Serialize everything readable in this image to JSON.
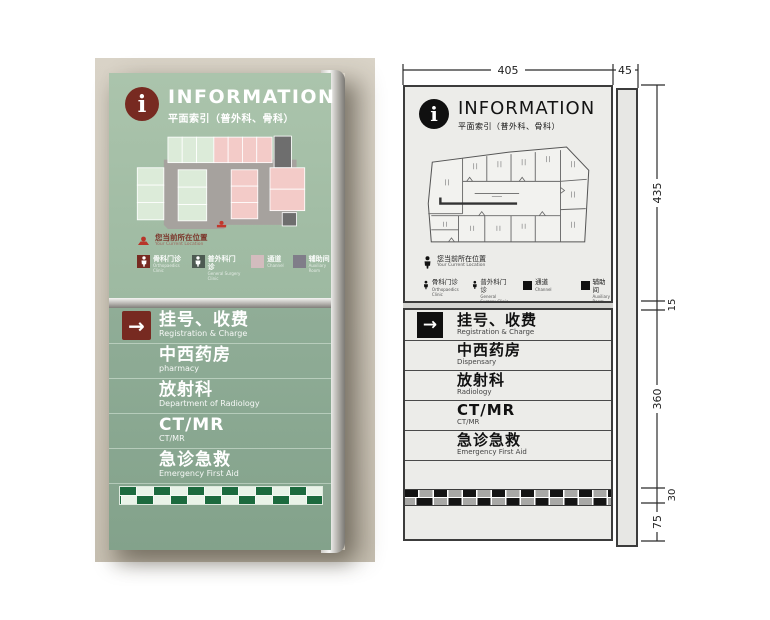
{
  "left_photo": {
    "header": {
      "icon": "i",
      "title": "INFORMATION",
      "subtitle": "平面索引（普外科、骨科）"
    },
    "you_are_here": {
      "zh": "您当前所在位置",
      "en": "Your Current Location"
    },
    "legend": [
      {
        "zh": "骨科门诊",
        "en": "Orthopaedics Clinic"
      },
      {
        "zh": "普外科门诊",
        "en": "General Surgery Clinic"
      },
      {
        "zh": "通道",
        "en": "Channel"
      },
      {
        "zh": "辅助间",
        "en": "Auxiliary Room"
      }
    ],
    "directory": [
      {
        "arrow": "→",
        "zh": "挂号、收费",
        "en": "Registration & Charge"
      },
      {
        "zh": "中西药房",
        "en": "pharmacy"
      },
      {
        "zh": "放射科",
        "en": "Department of Radiology"
      },
      {
        "zh": "CT/MR",
        "en": "CT/MR"
      },
      {
        "zh": "急诊急救",
        "en": "Emergency First Aid"
      }
    ]
  },
  "right_drawing": {
    "header": {
      "icon": "i",
      "title": "INFORMATION",
      "subtitle": "平面索引（普外科、骨科）"
    },
    "you_are_here": {
      "zh": "您当前所在位置",
      "en": "Your Current Location"
    },
    "legend": [
      {
        "zh": "骨科门诊",
        "en": "Orthopaedics Clinic"
      },
      {
        "zh": "普外科门诊",
        "en": "General Surgery Clinic"
      },
      {
        "zh": "通道",
        "en": "Channel"
      },
      {
        "zh": "辅助间",
        "en": "Auxiliary Room"
      }
    ],
    "directory": [
      {
        "arrow": "→",
        "zh": "挂号、收费",
        "en": "Registration & Charge"
      },
      {
        "zh": "中西药房",
        "en": "Dispensary"
      },
      {
        "zh": "放射科",
        "en": "Radiology"
      },
      {
        "zh": "CT/MR",
        "en": "CT/MR"
      },
      {
        "zh": "急诊急救",
        "en": "Emergency First Aid"
      }
    ],
    "dimensions": {
      "width": "405",
      "side": "45",
      "upper": "435",
      "gap": "15",
      "middle": "360",
      "stripe": "30",
      "lower": "75"
    }
  },
  "colors": {
    "board_green_light": "#abc4ac",
    "board_green_dark": "#8cab94",
    "accent_maroon": "#772a21",
    "checker_green": "#1c6a3e",
    "drawing_fill": "#ecece9",
    "drawing_line": "#3c3c3c"
  }
}
